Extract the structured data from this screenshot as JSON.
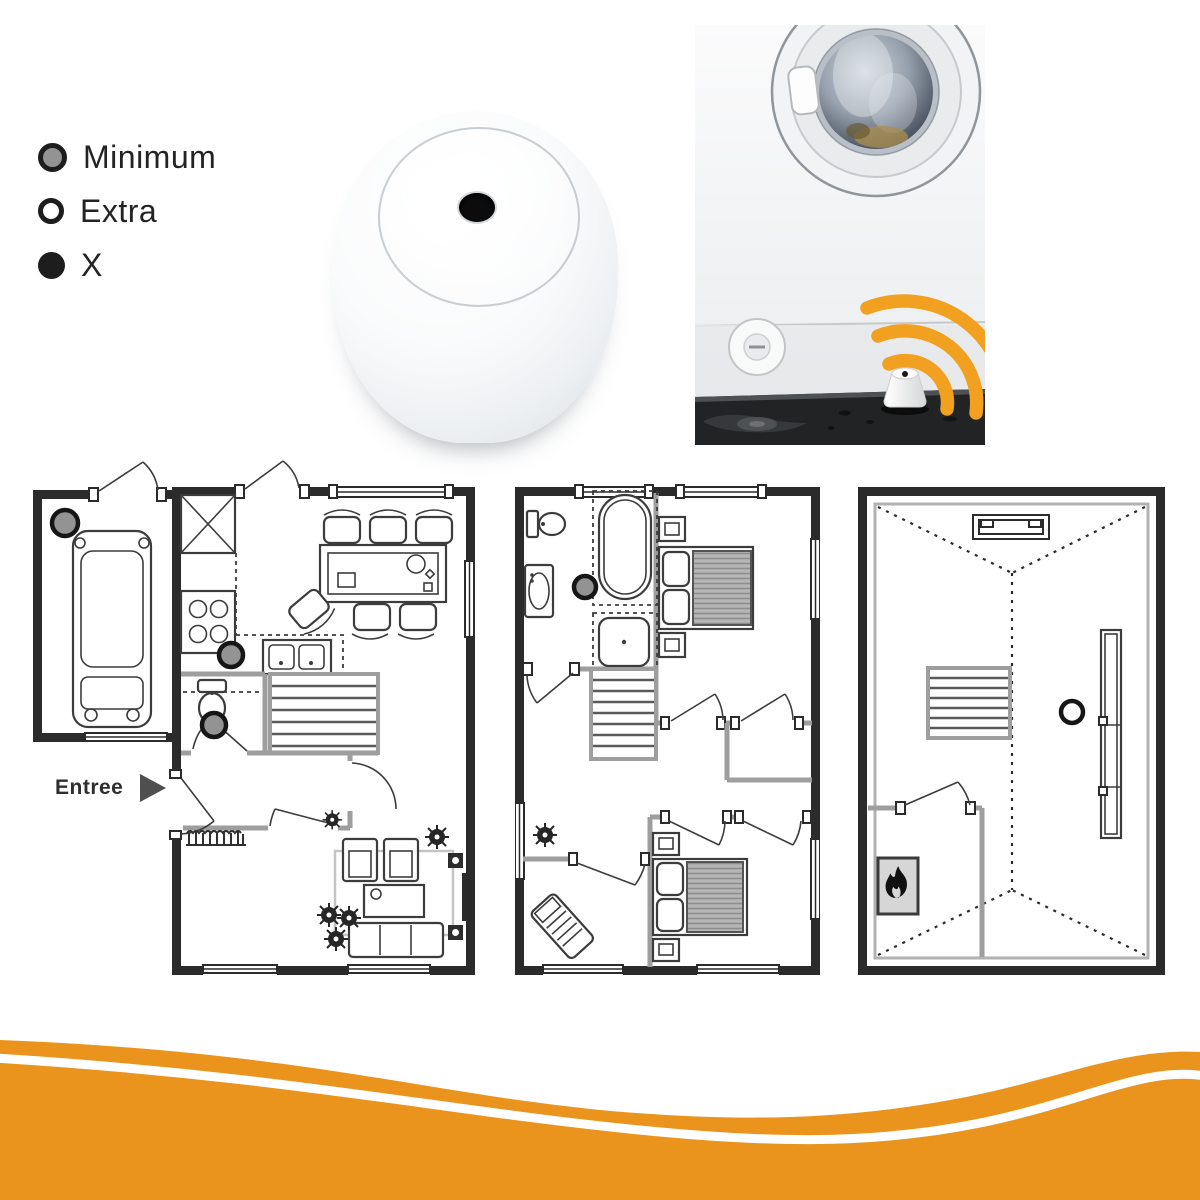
{
  "legend": {
    "items": [
      {
        "id": "minimum",
        "marker": "gray-circle",
        "label": "Minimum"
      },
      {
        "id": "extra",
        "marker": "white-circle",
        "label": "Extra"
      },
      {
        "id": "x",
        "marker": "black-circle",
        "label": "X"
      }
    ]
  },
  "floor_plans": {
    "entree_label": "Entree",
    "plans": [
      {
        "id": "ground-floor",
        "sensors": [
          {
            "type": "minimum",
            "x": 32,
            "y": 36,
            "r": 13
          },
          {
            "type": "minimum",
            "x": 198,
            "y": 168,
            "r": 12
          },
          {
            "type": "minimum",
            "x": 181,
            "y": 238,
            "r": 12
          }
        ]
      },
      {
        "id": "first-floor",
        "sensors": [
          {
            "type": "minimum",
            "x": 70,
            "y": 100,
            "r": 11
          }
        ]
      },
      {
        "id": "attic",
        "sensors": [
          {
            "type": "extra",
            "x": 214,
            "y": 225,
            "r": 11
          }
        ]
      }
    ]
  },
  "colors": {
    "accent_orange": "#EA941E",
    "wifi_orange": "#F2A01F",
    "marker_gray": "#939393",
    "marker_black": "#1d1d1d",
    "wall_dark": "#2b2b2b",
    "wall_gray": "#9e9e9e"
  }
}
